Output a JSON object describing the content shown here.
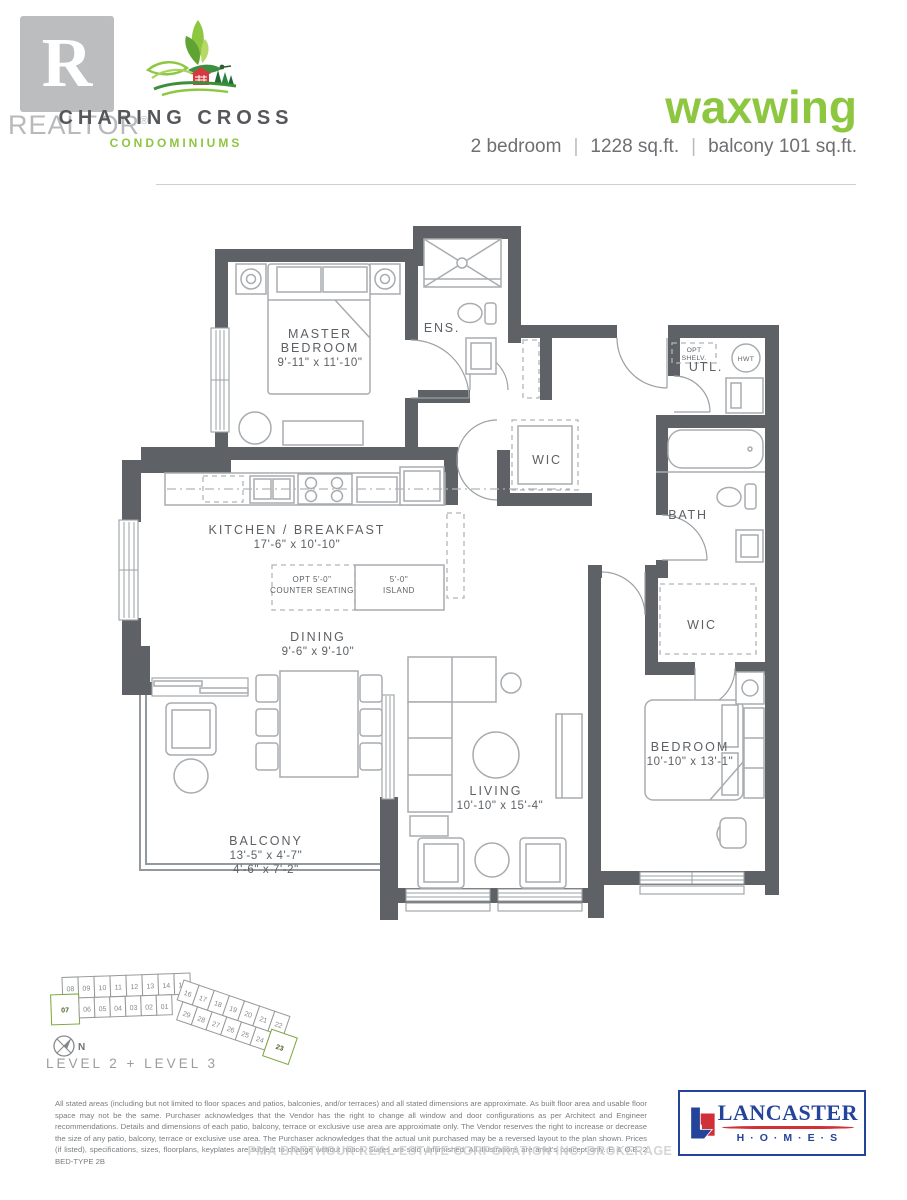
{
  "header": {
    "realtor_r": "R",
    "realtor_name": "REALTOR",
    "realtor_reg": "®",
    "brand_line1": "CHARING CROSS",
    "brand_line2": "CONDOMINIUMS",
    "plan_name": "waxwing",
    "specs": [
      "2 bedroom",
      "1228 sq.ft.",
      "balcony  101 sq.ft."
    ],
    "accent_green": "#8dc63f",
    "brand_gray": "#55575b"
  },
  "plan": {
    "master_bedroom": {
      "name1": "MASTER",
      "name2": "BEDROOM",
      "dims": "9'-11\" x 11'-10\""
    },
    "ensuite": {
      "name": "ENS."
    },
    "wic_master": {
      "name": "WIC"
    },
    "utility": {
      "name": "UTL.",
      "opt1": "OPT",
      "opt2": "SHELV.",
      "hwt": "HWT"
    },
    "bath": {
      "name": "BATH"
    },
    "kitchen": {
      "name": "KITCHEN / BREAKFAST",
      "dims": "17'-6\" x 10'-10\"",
      "counter_opt1": "OPT 5'-0\"",
      "counter_opt2": "COUNTER SEATING",
      "island1": "5'-0\"",
      "island2": "ISLAND"
    },
    "dining": {
      "name": "DINING",
      "dims": "9'-6\" x 9'-10\""
    },
    "living": {
      "name": "LIVING",
      "dims": "10'-10\" x 15'-4\""
    },
    "bedroom2": {
      "name": "BEDROOM",
      "dims": "10'-10\" x 13'-1\""
    },
    "wic_bedroom2": {
      "name": "WIC"
    },
    "balcony": {
      "name": "BALCONY",
      "dims1": "13'-5\" x 4'-7\"",
      "dims2": "4'-6\" x 7'-2\""
    }
  },
  "keyplate": {
    "level_label": "LEVEL 2 + LEVEL 3",
    "north_label": "N",
    "row_top": [
      "08",
      "09",
      "10",
      "11",
      "12",
      "13",
      "14",
      "15"
    ],
    "row_bottom": [
      "07",
      "06",
      "05",
      "04",
      "03",
      "02",
      "01"
    ],
    "wing_top": [
      "16",
      "17",
      "18",
      "19",
      "20",
      "21",
      "22"
    ],
    "wing_bottom": [
      "29",
      "28",
      "27",
      "26",
      "25",
      "24",
      "23"
    ],
    "highlighted_units": [
      "07",
      "23"
    ],
    "highlight_color": "#8cc63f"
  },
  "footer": {
    "disclaimer": "All stated areas (including but not limited to floor spaces and patios, balconies, and/or terraces) and all stated dimensions are approximate. As built floor area and usable floor space may not be the same. Purchaser acknowledges that the Vendor has the right to change all window and door configurations as per Architect and Engineer recommendations. Details and dimensions of each patio, balcony, terrace or exclusive use area are approximate only. The Vendor reserves the right to increase or decrease the size of any patio, balcony, terrace or exclusive use area. The Purchaser acknowledges that the actual unit purchased may be a reversed layout to the plan shown. Prices (if listed), specifications, sizes, floorplans, keyplates are subject to change without notice. Suites are sold unfurnished. All illustrations are artist's concept only. E & O.E. 2 BED-TYPE 2B",
    "watermark": "PMA BRETHOUR REAL ESTATE CORPORATION INC. BROKERAGE"
  },
  "builder": {
    "name": "LANCASTER",
    "sub": "H·O·M·E·S",
    "blue": "#24439a",
    "red": "#d03038"
  }
}
